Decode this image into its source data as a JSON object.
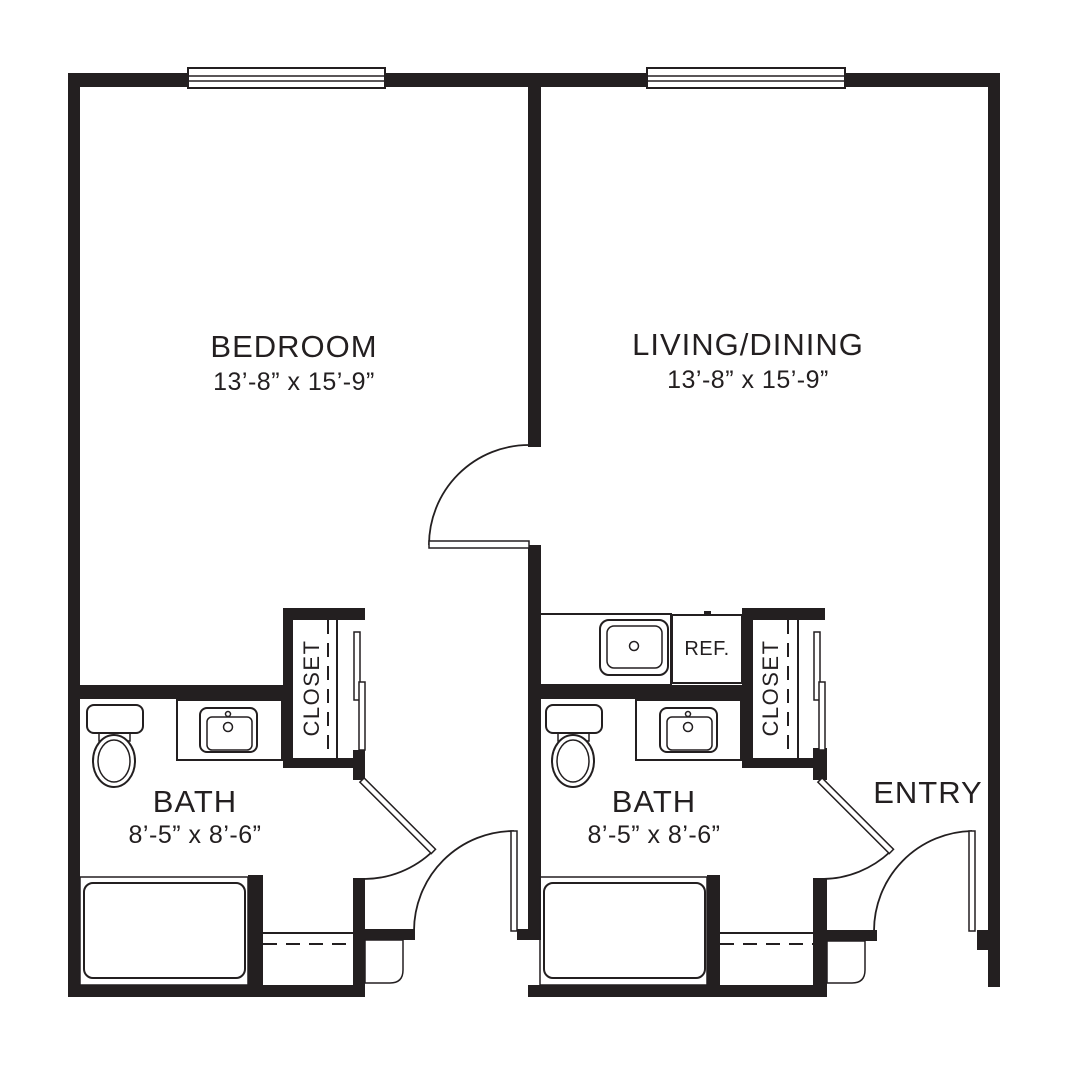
{
  "colors": {
    "ink": "#231f20",
    "paper": "#ffffff"
  },
  "rooms": {
    "bedroom": {
      "name": "BEDROOM",
      "dims": "13’-8” x 15’-9”"
    },
    "living": {
      "name": "LIVING/DINING",
      "dims": "13’-8” x 15’-9”"
    },
    "bath_left": {
      "name": "BATH",
      "dims": "8’-5” x 8’-6”"
    },
    "bath_right": {
      "name": "BATH",
      "dims": "8’-5” x 8’-6”"
    },
    "closet_left": {
      "name": "CLOSET"
    },
    "closet_right": {
      "name": "CLOSET"
    },
    "entry": {
      "name": "ENTRY"
    },
    "kitchen": {
      "ref_label": "REF."
    }
  }
}
